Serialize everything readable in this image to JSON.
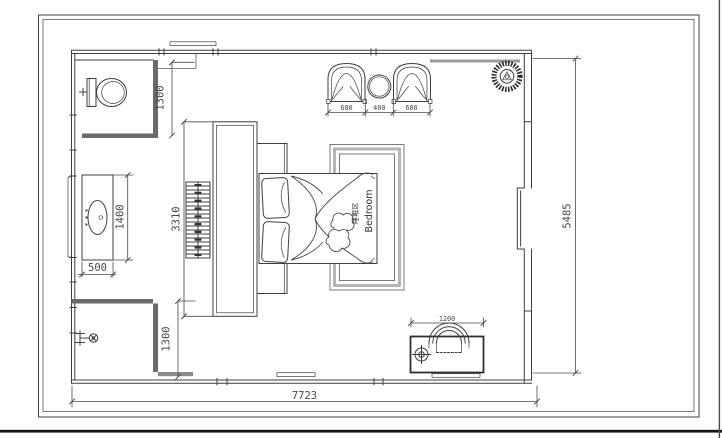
{
  "drawing": {
    "type": "bedroom floor plan (CAD)",
    "room_label_cn": "睡眠区",
    "room_label_en": "Bedroom",
    "dimensions": {
      "bathroom_width": "1300",
      "vanity_length": "1400",
      "vanity_depth": "500",
      "shower_width": "1300",
      "wardrobe_run": "3310",
      "armchair_left": "600",
      "tea_table": "400",
      "armchair_right": "600",
      "desk_width": "1200",
      "room_depth": "5485",
      "room_width": "7723"
    }
  },
  "colors": {
    "line": "#3f3f3f",
    "dark_fixture": "#6a6a6a",
    "rug_band": "#b5b5b5",
    "dimension_text": "#4a4a4a",
    "background": "#ffffff"
  }
}
